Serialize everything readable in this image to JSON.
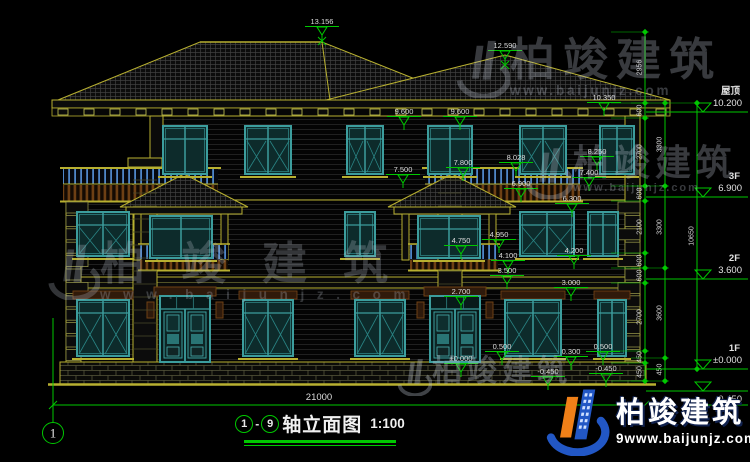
{
  "app": {
    "type": "CAD elevation drawing",
    "background": "#000000"
  },
  "colors": {
    "dimension_green": "#00c800",
    "cad_yellow": "#b8b030",
    "window_teal": "#3c9d9d",
    "text_white": "#dcdcdc",
    "brand_blue": "#2257c5",
    "brand_orange": "#f08018",
    "watermark_gray": "#b9c0cc"
  },
  "title_block": {
    "axis_from": "1",
    "axis_to": "9",
    "separator": "-",
    "name": "轴立面图",
    "scale": "1:100"
  },
  "axis_bubble": {
    "label": "1"
  },
  "overall_dimension": {
    "value": "21000"
  },
  "floor_levels": [
    {
      "label": "屋顶",
      "value": "10.200",
      "line_y": 112
    },
    {
      "label": "3F",
      "value": "6.900",
      "line_y": 197
    },
    {
      "label": "2F",
      "value": "3.600",
      "line_y": 279
    },
    {
      "label": "1F",
      "value": "±0.000",
      "line_y": 369
    },
    {
      "label": "",
      "value": "-0.450",
      "line_y": 391
    }
  ],
  "elevation_markers": [
    {
      "value": "13.156",
      "x": 322,
      "y": 24,
      "cross": true
    },
    {
      "value": "12.590",
      "x": 505,
      "y": 48,
      "cross": true
    },
    {
      "value": "10.350",
      "x": 604,
      "y": 100
    },
    {
      "value": "9.600",
      "x": 404,
      "y": 114
    },
    {
      "value": "9.600",
      "x": 460,
      "y": 114
    },
    {
      "value": "8.250",
      "x": 597,
      "y": 154
    },
    {
      "value": "8.028",
      "x": 516,
      "y": 160
    },
    {
      "value": "7.800",
      "x": 463,
      "y": 165
    },
    {
      "value": "7.500",
      "x": 403,
      "y": 172
    },
    {
      "value": "7.400",
      "x": 589,
      "y": 175
    },
    {
      "value": "6.900",
      "x": 521,
      "y": 186
    },
    {
      "value": "6.300",
      "x": 572,
      "y": 201
    },
    {
      "value": "4.950",
      "x": 499,
      "y": 237
    },
    {
      "value": "4.750",
      "x": 461,
      "y": 243
    },
    {
      "value": "4.200",
      "x": 574,
      "y": 253
    },
    {
      "value": "4.100",
      "x": 508,
      "y": 258
    },
    {
      "value": "3.500",
      "x": 507,
      "y": 273
    },
    {
      "value": "3.000",
      "x": 571,
      "y": 285
    },
    {
      "value": "2.700",
      "x": 461,
      "y": 294
    },
    {
      "value": "0.500",
      "x": 502,
      "y": 349
    },
    {
      "value": "0.300",
      "x": 571,
      "y": 354
    },
    {
      "value": "0.500",
      "x": 603,
      "y": 349
    },
    {
      "value": "±0.000",
      "x": 461,
      "y": 361
    },
    {
      "value": "-0.450",
      "x": 548,
      "y": 374
    },
    {
      "value": "-0.450",
      "x": 606,
      "y": 371
    }
  ],
  "dimension_chains": [
    {
      "x": 645,
      "segments": [
        {
          "from": 32,
          "to": 103,
          "label": "2956"
        },
        {
          "from": 103,
          "to": 118,
          "label": "600"
        },
        {
          "from": 118,
          "to": 186,
          "label": "2700"
        },
        {
          "from": 186,
          "to": 201,
          "label": "600"
        },
        {
          "from": 201,
          "to": 253,
          "label": "2100"
        },
        {
          "from": 253,
          "to": 268,
          "label": "600"
        },
        {
          "from": 268,
          "to": 283,
          "label": "600"
        },
        {
          "from": 283,
          "to": 351,
          "label": "2700"
        },
        {
          "from": 351,
          "to": 363,
          "label": "450"
        },
        {
          "from": 363,
          "to": 381,
          "label": "450"
        }
      ]
    },
    {
      "x": 665,
      "segments": [
        {
          "from": 103,
          "to": 186,
          "label": "3300"
        },
        {
          "from": 186,
          "to": 268,
          "label": "3300"
        },
        {
          "from": 268,
          "to": 358,
          "label": "3600"
        },
        {
          "from": 358,
          "to": 381,
          "label": "450"
        }
      ]
    },
    {
      "x": 697,
      "segments": [
        {
          "from": 103,
          "to": 369,
          "label": "10650"
        }
      ]
    }
  ],
  "watermarks": [
    {
      "text": "柏竣建筑",
      "url": "www.baijunjz.com",
      "x": 448,
      "y": 36,
      "char_size": 45,
      "spacing": 8,
      "logo": 62,
      "opacity": 0.3
    },
    {
      "text": "柏竣建筑",
      "url": "www.baijunjz.com",
      "x": 518,
      "y": 144,
      "char_size": 36,
      "spacing": 5,
      "logo": 55,
      "opacity": 0.3
    },
    {
      "text": "柏竣建筑",
      "url": "www.baijunjz.com",
      "x": 40,
      "y": 240,
      "char_size": 45,
      "spacing": 36,
      "logo": 60,
      "opacity": 0.27
    },
    {
      "text": "柏竣建筑",
      "url": "",
      "x": 392,
      "y": 356,
      "char_size": 30,
      "spacing": 5,
      "logo": 40,
      "opacity": 0.34
    }
  ],
  "branding": {
    "name": "柏竣建筑",
    "prefix": "9",
    "url": "www.baijunjz.com"
  }
}
